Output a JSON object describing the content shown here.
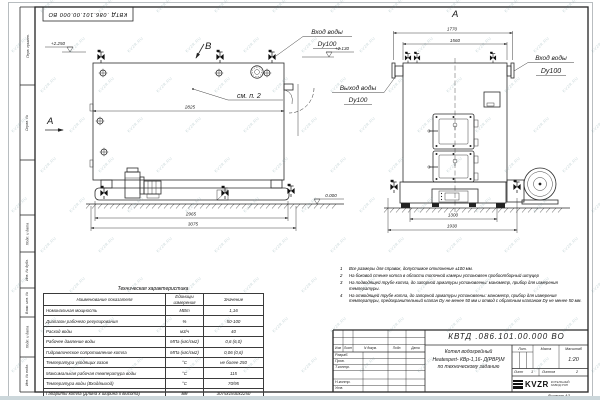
{
  "watermark": {
    "text": "KVZR.RU"
  },
  "doc": {
    "number": "КВТД .086.101.00.000  ВО",
    "format": "Формат  А3"
  },
  "stamp_vertical_labels": [
    "Перв. примен.",
    "Справ. №",
    "Подп. и дата",
    "Инв. № дубл.",
    "Взам. инв. №",
    "Подп. и дата",
    "Инв. № подл."
  ],
  "views": {
    "side": {
      "view_label": "B",
      "section_label": "А",
      "note_ref": "см. п. 2",
      "dim_width_top": "2825",
      "dim_width_mid": "2965",
      "dim_width_overall": "3075",
      "elev_top": "+2.250",
      "elev_nozzle": "+2.130",
      "elev_ground": "0.000"
    },
    "front": {
      "view_label": "А",
      "dim_flange_span": "1770",
      "dim_body_width": "1560",
      "dim_base_inner": "1300",
      "dim_base_overall": "1930"
    },
    "pipe_labels": {
      "inlet_top": {
        "line1": "Вход воды",
        "line2": "Dy100"
      },
      "outlet": {
        "line1": "Выход воды",
        "line2": "Dy100"
      },
      "inlet_front": {
        "line1": "Вход воды",
        "line2": "Dy100"
      }
    }
  },
  "notes": {
    "items": [
      {
        "num": "1",
        "text": "Все размеры для справок, допустимое отклонение  ±100 мм."
      },
      {
        "num": "2",
        "text": "На боковой стенке котла в области топочной камеры установлен пробоотборный штуцер"
      },
      {
        "num": "3",
        "text": "На  подводящей трубе котла, до запорной арматуры установлены:  манометр, прибор для измерения температуры."
      },
      {
        "num": "4",
        "text": "На отводящей трубе котла, до запорной арматуры установлены:  манометр, прибор для измерения температуры, предохранительный клапан  Dу не менее 50 мм и отвод с обратным клапаном  Dу не менее 50 мм."
      }
    ]
  },
  "spec_table": {
    "title": "Техническая характеристика",
    "headers": [
      "Наименование показателя",
      "Единицы измерения",
      "Значение"
    ],
    "rows": [
      [
        "Номинальная мощность",
        "МВт",
        "1,16"
      ],
      [
        "Диапазон рабочего регулирования",
        "%",
        "50-100"
      ],
      [
        "Расход воды",
        "м3/ч",
        "40"
      ],
      [
        "Рабочее давление воды",
        "МПа (кгс/см2)",
        "0,6 (6,0)"
      ],
      [
        "Гидравлическое сопротивление котла",
        "МПа (кгс/см2)",
        "0,06 (0,6)"
      ],
      [
        "Температура уходящих газов",
        "°С",
        "не более 250"
      ],
      [
        "Максимальная рабочая температура воды",
        "°С",
        "115"
      ],
      [
        "Температура воды (Вход/выход)",
        "°С",
        "70/95"
      ],
      [
        "Габариты котла (Длина х ширина х высота)",
        "мм",
        "3075х1930х2250"
      ]
    ]
  },
  "title_block": {
    "doc_number": "КВТД .086.101.00.000  ВО",
    "name_line1": "Котел водогрейный",
    "name_line2": "Heatexpert- КВр-1,16- Д(РВР)М",
    "name_line3": "по техническому заданию",
    "col_izm": "Изм",
    "col_list": "Лист",
    "col_doc": "N докум.",
    "col_sign": "Подп.",
    "col_date": "Дата",
    "row_developed": "Разраб.",
    "row_checked": "Пров.",
    "row_tcontrol": "Т.контр.",
    "row_ncontrol": "Н.контр.",
    "row_approved": "Утв.",
    "lit_label": "Лит.",
    "mass_label": "Масса",
    "scale_label": "Масштаб",
    "scale_value": "1:20",
    "sheet_label": "Лист",
    "sheet_value": "1",
    "sheets_label": "Листов",
    "sheets_value": "2",
    "company_name": "KVZR",
    "company_line1": "КОТЕЛЬНЫЙ",
    "company_line2": "ЗАВОД РЭП"
  }
}
